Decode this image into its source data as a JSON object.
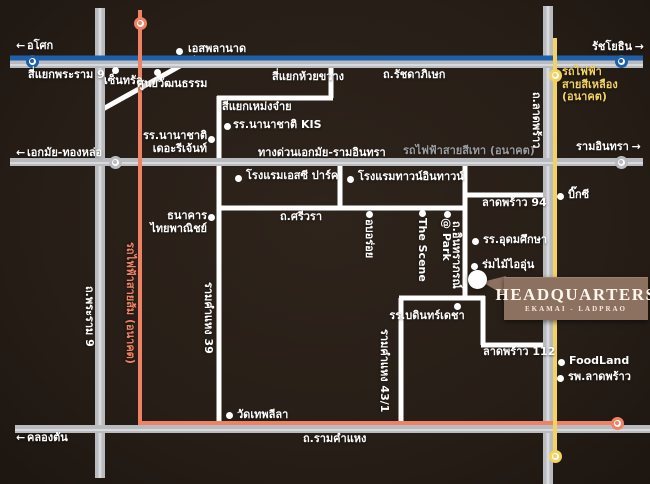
{
  "hq": {
    "title": "HEADQUARTERS",
    "subtitle": "EKAMAI - LADPRAO",
    "marker": {
      "x": 477,
      "y": 279
    }
  },
  "colors": {
    "bg": "#271e17",
    "road_white": "#ffffff",
    "road_gray": "#b9bbbf",
    "road_gray_hi": "#d8d9dc",
    "line_blue": "#1d5fa9",
    "line_orange": "#ef8164",
    "line_yellow": "#f2d261",
    "text_white": "#ffffff",
    "text_gray": "#9b9ca0",
    "hq_box": "#8d7160"
  },
  "labels": [
    {
      "id": "label-asok",
      "text": "อโศก",
      "x": 16,
      "y": 40,
      "arrow": "left"
    },
    {
      "id": "label-esplanade",
      "text": "เอสพลานาด",
      "x": 188,
      "y": 43
    },
    {
      "id": "label-ratchayothin",
      "text": "รัชโยธิน",
      "x": 592,
      "y": 41,
      "arrow": "right"
    },
    {
      "id": "label-rama9-junction",
      "text": "สี่แยกพระราม 9",
      "x": 28,
      "y": 69
    },
    {
      "id": "label-central",
      "text": "เซ็นทรัล",
      "x": 104,
      "y": 75
    },
    {
      "id": "label-culture-centre",
      "text": "ศูนย์วัฒนธรรม",
      "x": 137,
      "y": 78
    },
    {
      "id": "label-huai-khwang",
      "text": "สี่แยกห้วยขวาง",
      "x": 272,
      "y": 71
    },
    {
      "id": "label-ratchadaphisek-rd",
      "text": "ถ.รัชดาภิเษก",
      "x": 383,
      "y": 69
    },
    {
      "id": "label-yellow-line",
      "text": "รถไฟฟ้า\nสายสีเหลือง\n(อนาคต)",
      "x": 562,
      "y": 66,
      "cls": "yellow"
    },
    {
      "id": "label-meng-jai",
      "text": "สี่แยกเหม่งจ๋าย",
      "x": 222,
      "y": 101
    },
    {
      "id": "label-kis",
      "text": "รร.นานาชาติ KIS",
      "x": 233,
      "y": 119
    },
    {
      "id": "label-regent",
      "text": "รร.นานาชาติ\nเดอะรีเจ้นท์",
      "x": 143,
      "y": 130,
      "cls": "right",
      "w": 64
    },
    {
      "id": "label-ekamai-thonglor",
      "text": "เอกมัย-ทองหล่อ",
      "x": 16,
      "y": 147,
      "arrow": "left"
    },
    {
      "id": "label-expressway",
      "text": "ทางด่วนเอกมัย-รามอินทรา",
      "x": 258,
      "y": 147
    },
    {
      "id": "label-grey-line",
      "text": "รถไฟฟ้าสายสีเทา (อนาคต)",
      "x": 403,
      "y": 145,
      "cls": "gray"
    },
    {
      "id": "label-ram-inthra",
      "text": "รามอินทรา",
      "x": 576,
      "y": 141,
      "arrow": "right"
    },
    {
      "id": "label-ladprao-rd",
      "text": "ถ.ลาดพร้าว",
      "x": 542,
      "y": 92,
      "cls": "v"
    },
    {
      "id": "label-sc-park",
      "text": "โรงแรมเอสซี ปาร์ค",
      "x": 246,
      "y": 170
    },
    {
      "id": "label-town-in-town",
      "text": "โรงแรมทาวน์อินทาวน์",
      "x": 358,
      "y": 171
    },
    {
      "id": "label-scb",
      "text": "ธนาคาร\nไทยพาณิชย์",
      "x": 143,
      "y": 210,
      "cls": "right",
      "w": 64
    },
    {
      "id": "label-sriwara-rd",
      "text": "ถ.ศรีวรา",
      "x": 280,
      "y": 211
    },
    {
      "id": "label-ob-aroi",
      "text": "อบอร่อย",
      "x": 375,
      "y": 219,
      "cls": "v"
    },
    {
      "id": "label-the-scene",
      "text": "The Scene",
      "x": 428,
      "y": 218,
      "cls": "v"
    },
    {
      "id": "label-at-park",
      "text": "@ Park",
      "x": 452,
      "y": 218,
      "cls": "v"
    },
    {
      "id": "label-inthraphorn-rd",
      "text": "ถ.อินทราภรณ์",
      "x": 462,
      "y": 221,
      "cls": "v"
    },
    {
      "id": "label-ladprao-94",
      "text": "ลาดพร้าว 94",
      "x": 482,
      "y": 197
    },
    {
      "id": "label-big-c",
      "text": "บิ๊กซี",
      "x": 568,
      "y": 189
    },
    {
      "id": "label-udomsuksa",
      "text": "รร.อุดมศึกษา",
      "x": 483,
      "y": 234
    },
    {
      "id": "label-rom-mai-ai-un",
      "text": "ร่มไม้ไออุ่น",
      "x": 482,
      "y": 259
    },
    {
      "id": "label-bodindecha",
      "text": "รร.บดินทร์เดชา",
      "x": 379,
      "y": 310,
      "cls": "center",
      "w": 96
    },
    {
      "id": "label-rama9-rd",
      "text": "ถ.พระราม 9",
      "x": 95,
      "y": 286,
      "cls": "v"
    },
    {
      "id": "label-orange-line",
      "text": "รถไฟฟ้าสายส้ม (อนาคต)",
      "x": 136,
      "y": 242,
      "cls": "v orange"
    },
    {
      "id": "label-ram-39",
      "text": "รามคำแหง 39",
      "x": 214,
      "y": 282,
      "cls": "v"
    },
    {
      "id": "label-ram-43-1",
      "text": "รามคำแหง 43/1",
      "x": 390,
      "y": 329,
      "cls": "v"
    },
    {
      "id": "label-wat-thep-leela",
      "text": "วัดเทพลีลา",
      "x": 237,
      "y": 409
    },
    {
      "id": "label-ladprao-112",
      "text": "ลาดพร้าว 112",
      "x": 483,
      "y": 346
    },
    {
      "id": "label-foodland",
      "text": "FoodLand",
      "x": 569,
      "y": 355
    },
    {
      "id": "label-ladprao-hospital",
      "text": "รพ.ลาดพร้าว",
      "x": 568,
      "y": 371
    },
    {
      "id": "label-ramkhamhaeng-rd",
      "text": "ถ.รามคำแหง",
      "x": 303,
      "y": 433
    },
    {
      "id": "label-khlong-tan",
      "text": "คลองตัน",
      "x": 16,
      "y": 432,
      "arrow": "left"
    }
  ],
  "arrow_glyphs": {
    "left": "←",
    "right": "→"
  },
  "dots": [
    {
      "id": "dot-esplanade",
      "x": 179,
      "y": 51
    },
    {
      "id": "dot-central",
      "x": 115,
      "y": 70
    },
    {
      "id": "dot-culture-centre",
      "x": 157,
      "y": 72
    },
    {
      "id": "dot-kis",
      "x": 227,
      "y": 126
    },
    {
      "id": "dot-regent",
      "x": 211,
      "y": 139
    },
    {
      "id": "dot-sc-park",
      "x": 238,
      "y": 178
    },
    {
      "id": "dot-town-in-town",
      "x": 350,
      "y": 179
    },
    {
      "id": "dot-scb",
      "x": 211,
      "y": 217
    },
    {
      "id": "dot-ob-aroi",
      "x": 369,
      "y": 214
    },
    {
      "id": "dot-the-scene",
      "x": 422,
      "y": 213
    },
    {
      "id": "dot-at-park",
      "x": 447,
      "y": 214
    },
    {
      "id": "dot-big-c",
      "x": 560,
      "y": 196
    },
    {
      "id": "dot-udomsuksa",
      "x": 475,
      "y": 241
    },
    {
      "id": "dot-rom-mai-ai-un",
      "x": 474,
      "y": 266
    },
    {
      "id": "dot-bodindecha",
      "x": 457,
      "y": 306
    },
    {
      "id": "dot-wat-thep-leela",
      "x": 229,
      "y": 415
    },
    {
      "id": "dot-foodland",
      "x": 561,
      "y": 362
    },
    {
      "id": "dot-ladprao-hospital",
      "x": 560,
      "y": 378
    }
  ],
  "terminals": [
    {
      "id": "terminal-blue-asok",
      "x": 32,
      "y": 61,
      "color": "blue"
    },
    {
      "id": "terminal-blue-ratchayothin",
      "x": 621,
      "y": 61,
      "color": "blue"
    },
    {
      "id": "terminal-gray-ekamai",
      "x": 115,
      "y": 162,
      "color": "gray"
    },
    {
      "id": "terminal-gray-raminthra",
      "x": 621,
      "y": 162,
      "color": "gray"
    },
    {
      "id": "terminal-yellow-top",
      "x": 555,
      "y": 75,
      "color": "yellow"
    },
    {
      "id": "terminal-yellow-bottom",
      "x": 555,
      "y": 456,
      "color": "yellow"
    },
    {
      "id": "terminal-orange-top",
      "x": 140,
      "y": 23,
      "color": "orange"
    },
    {
      "id": "terminal-orange-east",
      "x": 617,
      "y": 423,
      "color": "orange"
    }
  ]
}
